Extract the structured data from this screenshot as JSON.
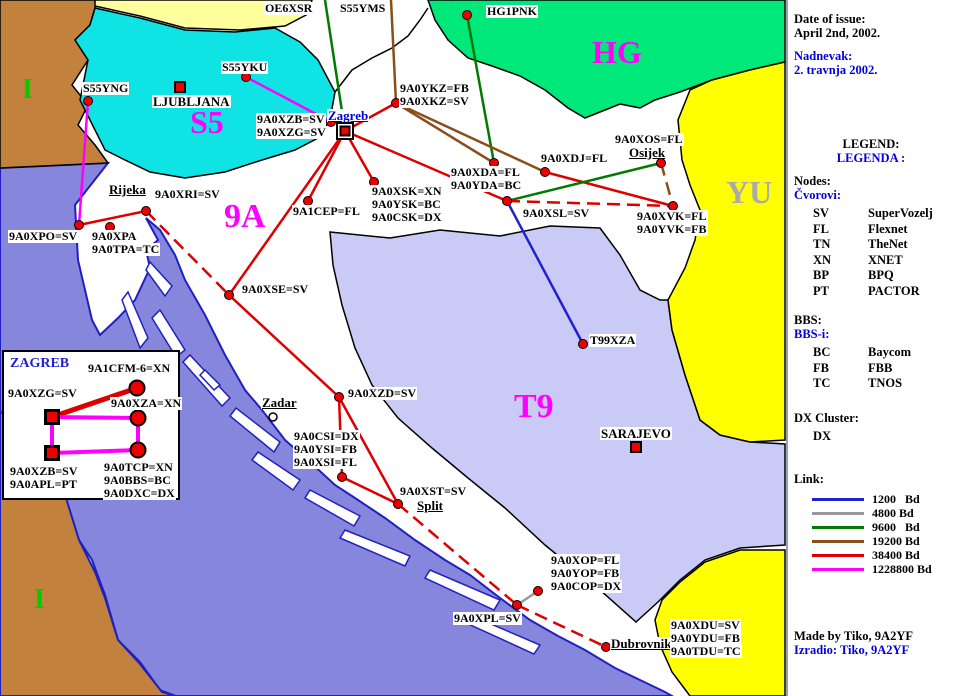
{
  "panel": {
    "date_label": "Date of issue:",
    "date_value": "April 2nd, 2002.",
    "date_label_hr": "Nadnevak:",
    "date_value_hr": "2. travnja 2002.",
    "legend_title": "LEGEND:",
    "legend_title_hr": "LEGENDA :",
    "nodes_title": "Nodes:",
    "nodes_title_hr": "Čvorovi:",
    "node_types": [
      {
        "abbr": "SV",
        "name": "SuperVozelj"
      },
      {
        "abbr": "FL",
        "name": "Flexnet"
      },
      {
        "abbr": "TN",
        "name": "TheNet"
      },
      {
        "abbr": "XN",
        "name": "XNET"
      },
      {
        "abbr": "BP",
        "name": "BPQ"
      },
      {
        "abbr": "PT",
        "name": "PACTOR"
      }
    ],
    "bbs_title": "BBS:",
    "bbs_title_hr": "BBS-i:",
    "bbs_types": [
      {
        "abbr": "BC",
        "name": "Baycom"
      },
      {
        "abbr": "FB",
        "name": "FBB"
      },
      {
        "abbr": "TC",
        "name": "TNOS"
      }
    ],
    "dx_title": "DX Cluster:",
    "dx_value": "DX",
    "link_title": "Link:",
    "link_speeds": [
      {
        "label": "1200   Bd",
        "speed": "1200"
      },
      {
        "label": "4800 Bd",
        "speed": "4800"
      },
      {
        "label": "9600   Bd",
        "speed": "9600"
      },
      {
        "label": "19200 Bd",
        "speed": "19200"
      },
      {
        "label": "38400 Bd",
        "speed": "38400"
      },
      {
        "label": "1228800 Bd",
        "speed": "1228800"
      }
    ],
    "credit": "Made by Tiko, 9A2YF",
    "credit_hr": "Izradio: Tiko, 9A2YF"
  },
  "map": {
    "link_colors": {
      "1200": "#2222cc",
      "4800": "#999999",
      "9600": "#007a00",
      "19200": "#8b4d1a",
      "38400": "#dd0000",
      "1228800": "#ff00ff"
    },
    "regions": [
      {
        "text": "I",
        "x": 22,
        "y": 76,
        "color": "#00cc00",
        "size": 28
      },
      {
        "text": "S5",
        "x": 190,
        "y": 106,
        "color": "#ff00ff",
        "size": 32
      },
      {
        "text": "9A",
        "x": 224,
        "y": 200,
        "color": "#ff00ff",
        "size": 34
      },
      {
        "text": "HG",
        "x": 592,
        "y": 36,
        "color": "#ff00ff",
        "size": 32
      },
      {
        "text": "YU",
        "x": 726,
        "y": 176,
        "color": "#aaaaaa",
        "size": 32
      },
      {
        "text": "T9",
        "x": 514,
        "y": 390,
        "color": "#ff00ff",
        "size": 34
      },
      {
        "text": "I",
        "x": 34,
        "y": 586,
        "color": "#00cc00",
        "size": 28
      }
    ],
    "nodes": [
      {
        "id": "S55YNG",
        "marker": "dot",
        "x": 88,
        "y": 101,
        "lx": 82,
        "ly": 82,
        "lines": [
          "S55YNG"
        ]
      },
      {
        "id": "S55YKU",
        "marker": "dot",
        "x": 246,
        "y": 77,
        "lx": 221,
        "ly": 61,
        "lines": [
          "S55YKU"
        ]
      },
      {
        "id": "LJUBLJANA",
        "marker": "square",
        "x": 180,
        "y": 87,
        "lx": 152,
        "ly": 95,
        "city": true,
        "lines": [
          "LJUBLJANA"
        ]
      },
      {
        "id": "OE6XSR",
        "marker": "none",
        "lx": 264,
        "ly": 2,
        "lines": [
          "OE6XSR"
        ]
      },
      {
        "id": "S55YMS",
        "marker": "none",
        "lx": 339,
        "ly": 2,
        "lines": [
          "S55YMS"
        ]
      },
      {
        "id": "HG1PNK",
        "marker": "dot",
        "x": 467,
        "y": 15,
        "lx": 486,
        "ly": 5,
        "lines": [
          "HG1PNK"
        ]
      },
      {
        "id": "Zagreb",
        "marker": "zagreb",
        "x": 345,
        "y": 131,
        "lx": 327,
        "ly": 109,
        "city": true,
        "blue": true,
        "underline": true,
        "lines": [
          "Zagreb"
        ]
      },
      {
        "id": "9A0XZB",
        "marker": "dot",
        "x": 331,
        "y": 122,
        "lx": 256,
        "ly": 113,
        "lines": [
          "9A0XZB=SV",
          "9A0XZG=SV"
        ]
      },
      {
        "id": "9A0XKZ",
        "marker": "dot",
        "x": 396,
        "y": 103,
        "lx": 399,
        "ly": 82,
        "lines": [
          "9A0YKZ=FB",
          "9A0XKZ=SV"
        ]
      },
      {
        "id": "9A0XDJ",
        "marker": "dot",
        "x": 545,
        "y": 172,
        "lx": 540,
        "ly": 152,
        "lines": [
          "9A0XDJ=FL"
        ]
      },
      {
        "id": "9A0XOS",
        "marker": "dot",
        "x": 661,
        "y": 163,
        "lx": 614,
        "ly": 133,
        "lines": [
          "9A0XOS=FL"
        ]
      },
      {
        "id": "Osijek",
        "marker": "none",
        "lx": 628,
        "ly": 146,
        "city": true,
        "underline": true,
        "lines": [
          "Osijek"
        ]
      },
      {
        "id": "9A0XVK",
        "marker": "dot",
        "x": 673,
        "y": 206,
        "lx": 636,
        "ly": 210,
        "lines": [
          "9A0XVK=FL",
          "9A0YVK=FB"
        ]
      },
      {
        "id": "9A0XDA",
        "marker": "dot",
        "x": 494,
        "y": 163,
        "lx": 450,
        "ly": 166,
        "lines": [
          "9A0XDA=FL",
          "9A0YDA=BC"
        ]
      },
      {
        "id": "9A0XSL",
        "marker": "dot",
        "x": 507,
        "y": 201,
        "lx": 522,
        "ly": 207,
        "lines": [
          "9A0XSL=SV"
        ]
      },
      {
        "id": "9A1CEP",
        "marker": "dot",
        "x": 308,
        "y": 201,
        "lx": 292,
        "ly": 205,
        "lines": [
          "9A1CEP=FL"
        ]
      },
      {
        "id": "9A0XSK",
        "marker": "dot",
        "x": 374,
        "y": 182,
        "lx": 371,
        "ly": 185,
        "lines": [
          "9A0XSK=XN",
          "9A0YSK=BC",
          "9A0CSK=DX"
        ]
      },
      {
        "id": "9A0XRI",
        "marker": "dot",
        "x": 146,
        "y": 211,
        "lx": 154,
        "ly": 188,
        "lines": [
          "9A0XRI=SV"
        ]
      },
      {
        "id": "Rijeka",
        "marker": "none",
        "lx": 108,
        "ly": 183,
        "city": true,
        "underline": true,
        "lines": [
          "Rijeka"
        ]
      },
      {
        "id": "9A0XPO",
        "marker": "dot",
        "x": 79,
        "y": 225,
        "lx": 8,
        "ly": 230,
        "lines": [
          "9A0XPO=SV"
        ]
      },
      {
        "id": "9A0XPA",
        "marker": "dot",
        "x": 110,
        "y": 227,
        "lx": 91,
        "ly": 230,
        "lines": [
          "9A0XPA",
          "9A0TPA=TC"
        ]
      },
      {
        "id": "9A0XSE",
        "marker": "dot",
        "x": 229,
        "y": 295,
        "lx": 241,
        "ly": 283,
        "lines": [
          "9A0XSE=SV"
        ]
      },
      {
        "id": "9A0XZD",
        "marker": "dot",
        "x": 339,
        "y": 397,
        "lx": 347,
        "ly": 387,
        "lines": [
          "9A0XZD=SV"
        ]
      },
      {
        "id": "Zadar",
        "marker": "circle",
        "x": 273,
        "y": 417,
        "lx": 261,
        "ly": 396,
        "city": true,
        "underline": true,
        "lines": [
          "Zadar"
        ]
      },
      {
        "id": "9A0CSI",
        "marker": "dot",
        "x": 342,
        "y": 477,
        "lx": 293,
        "ly": 430,
        "lines": [
          "9A0CSI=DX",
          "9A0YSI=FB",
          "9A0XSI=FL"
        ]
      },
      {
        "id": "9A0XST",
        "marker": "dot",
        "x": 398,
        "y": 504,
        "lx": 399,
        "ly": 485,
        "lines": [
          "9A0XST=SV"
        ]
      },
      {
        "id": "Split",
        "marker": "none",
        "lx": 416,
        "ly": 499,
        "city": true,
        "underline": true,
        "lines": [
          "Split"
        ]
      },
      {
        "id": "T99XZA",
        "marker": "dot",
        "x": 583,
        "y": 344,
        "lx": 589,
        "ly": 334,
        "lines": [
          "T99XZA"
        ]
      },
      {
        "id": "SARAJEVO",
        "marker": "square",
        "x": 636,
        "y": 447,
        "lx": 600,
        "ly": 427,
        "city": true,
        "lines": [
          "SARAJEVO"
        ]
      },
      {
        "id": "9A0XOP",
        "marker": "dot",
        "x": 538,
        "y": 591,
        "lx": 550,
        "ly": 554,
        "lines": [
          "9A0XOP=FL",
          "9A0YOP=FB",
          "9A0COP=DX"
        ]
      },
      {
        "id": "9A0XPL",
        "marker": "dot",
        "x": 517,
        "y": 605,
        "lx": 453,
        "ly": 612,
        "lines": [
          "9A0XPL=SV"
        ]
      },
      {
        "id": "Dubrovnik",
        "marker": "dot",
        "x": 606,
        "y": 647,
        "lx": 610,
        "ly": 637,
        "city": true,
        "underline": true,
        "lines": [
          "Dubrovnik"
        ]
      },
      {
        "id": "9A0XDU",
        "marker": "none",
        "lx": 670,
        "ly": 619,
        "lines": [
          "9A0XDU=SV",
          "9A0YDU=FB",
          "9A0TDU=TC"
        ]
      }
    ],
    "links": [
      {
        "x1": 325,
        "y1": 0,
        "x2": 345,
        "y2": 131,
        "speed": "9600"
      },
      {
        "x1": 391,
        "y1": 0,
        "x2": 396,
        "y2": 103,
        "speed": "19200"
      },
      {
        "x1": 467,
        "y1": 15,
        "x2": 494,
        "y2": 163,
        "speed": "9600"
      },
      {
        "x1": 246,
        "y1": 77,
        "x2": 333,
        "y2": 123,
        "speed": "1228800"
      },
      {
        "x1": 88,
        "y1": 101,
        "x2": 79,
        "y2": 225,
        "speed": "1228800"
      },
      {
        "x1": 345,
        "y1": 131,
        "x2": 396,
        "y2": 103,
        "speed": "38400"
      },
      {
        "x1": 396,
        "y1": 103,
        "x2": 494,
        "y2": 163,
        "speed": "19200"
      },
      {
        "x1": 396,
        "y1": 103,
        "x2": 545,
        "y2": 172,
        "speed": "19200"
      },
      {
        "x1": 545,
        "y1": 172,
        "x2": 673,
        "y2": 206,
        "speed": "38400"
      },
      {
        "x1": 661,
        "y1": 163,
        "x2": 673,
        "y2": 206,
        "speed": "19200",
        "dashed": true
      },
      {
        "x1": 507,
        "y1": 201,
        "x2": 661,
        "y2": 163,
        "speed": "9600"
      },
      {
        "x1": 507,
        "y1": 201,
        "x2": 673,
        "y2": 206,
        "speed": "38400",
        "dashed": true
      },
      {
        "x1": 345,
        "y1": 131,
        "x2": 507,
        "y2": 201,
        "speed": "38400"
      },
      {
        "x1": 345,
        "y1": 131,
        "x2": 308,
        "y2": 201,
        "speed": "38400"
      },
      {
        "x1": 345,
        "y1": 131,
        "x2": 374,
        "y2": 182,
        "speed": "38400"
      },
      {
        "x1": 345,
        "y1": 131,
        "x2": 229,
        "y2": 295,
        "speed": "38400"
      },
      {
        "x1": 507,
        "y1": 201,
        "x2": 583,
        "y2": 344,
        "speed": "1200"
      },
      {
        "x1": 79,
        "y1": 225,
        "x2": 146,
        "y2": 211,
        "speed": "38400"
      },
      {
        "x1": 146,
        "y1": 211,
        "x2": 229,
        "y2": 295,
        "speed": "38400",
        "dashed": true
      },
      {
        "x1": 229,
        "y1": 295,
        "x2": 339,
        "y2": 397,
        "speed": "38400"
      },
      {
        "x1": 339,
        "y1": 397,
        "x2": 342,
        "y2": 477,
        "speed": "38400"
      },
      {
        "x1": 339,
        "y1": 397,
        "x2": 398,
        "y2": 504,
        "speed": "38400"
      },
      {
        "x1": 342,
        "y1": 477,
        "x2": 398,
        "y2": 504,
        "speed": "38400"
      },
      {
        "x1": 398,
        "y1": 504,
        "x2": 517,
        "y2": 605,
        "speed": "38400",
        "dashed": true
      },
      {
        "x1": 517,
        "y1": 605,
        "x2": 606,
        "y2": 647,
        "speed": "38400",
        "dashed": true
      },
      {
        "x1": 517,
        "y1": 605,
        "x2": 538,
        "y2": 591,
        "speed": "4800"
      }
    ]
  },
  "inset": {
    "title": "ZAGREB",
    "nodes": [
      {
        "id": "9A0XZG",
        "marker": "isquare",
        "x": 52,
        "y": 417,
        "lx": 7,
        "ly": 387,
        "lines": [
          "9A0XZG=SV"
        ]
      },
      {
        "id": "9A1CFM-6",
        "marker": "icircle",
        "x": 137,
        "y": 388,
        "lx": 87,
        "ly": 362,
        "lines": [
          "9A1CFM-6=XN"
        ]
      },
      {
        "id": "9A0XZA",
        "marker": "icircle",
        "x": 138,
        "y": 418,
        "lx": 110,
        "ly": 397,
        "lines": [
          "9A0XZA=XN"
        ]
      },
      {
        "id": "9A0XZB-inset",
        "marker": "isquare",
        "x": 52,
        "y": 453,
        "lx": 9,
        "ly": 465,
        "lines": [
          "9A0XZB=SV",
          "9A0APL=PT"
        ]
      },
      {
        "id": "9A0TCP",
        "marker": "icircle",
        "x": 138,
        "y": 450,
        "lx": 103,
        "ly": 461,
        "lines": [
          "9A0TCP=XN",
          "9A0BBS=BC",
          "9A0DXC=DX"
        ]
      }
    ],
    "links": [
      {
        "x1": 52,
        "y1": 417,
        "x2": 137,
        "y2": 388,
        "speed": "38400"
      },
      {
        "x1": 52,
        "y1": 417,
        "x2": 138,
        "y2": 418,
        "speed": "1228800"
      },
      {
        "x1": 52,
        "y1": 417,
        "x2": 52,
        "y2": 453,
        "speed": "1228800"
      },
      {
        "x1": 52,
        "y1": 453,
        "x2": 138,
        "y2": 450,
        "speed": "1228800"
      },
      {
        "x1": 138,
        "y1": 418,
        "x2": 138,
        "y2": 450,
        "speed": "1228800"
      }
    ]
  }
}
